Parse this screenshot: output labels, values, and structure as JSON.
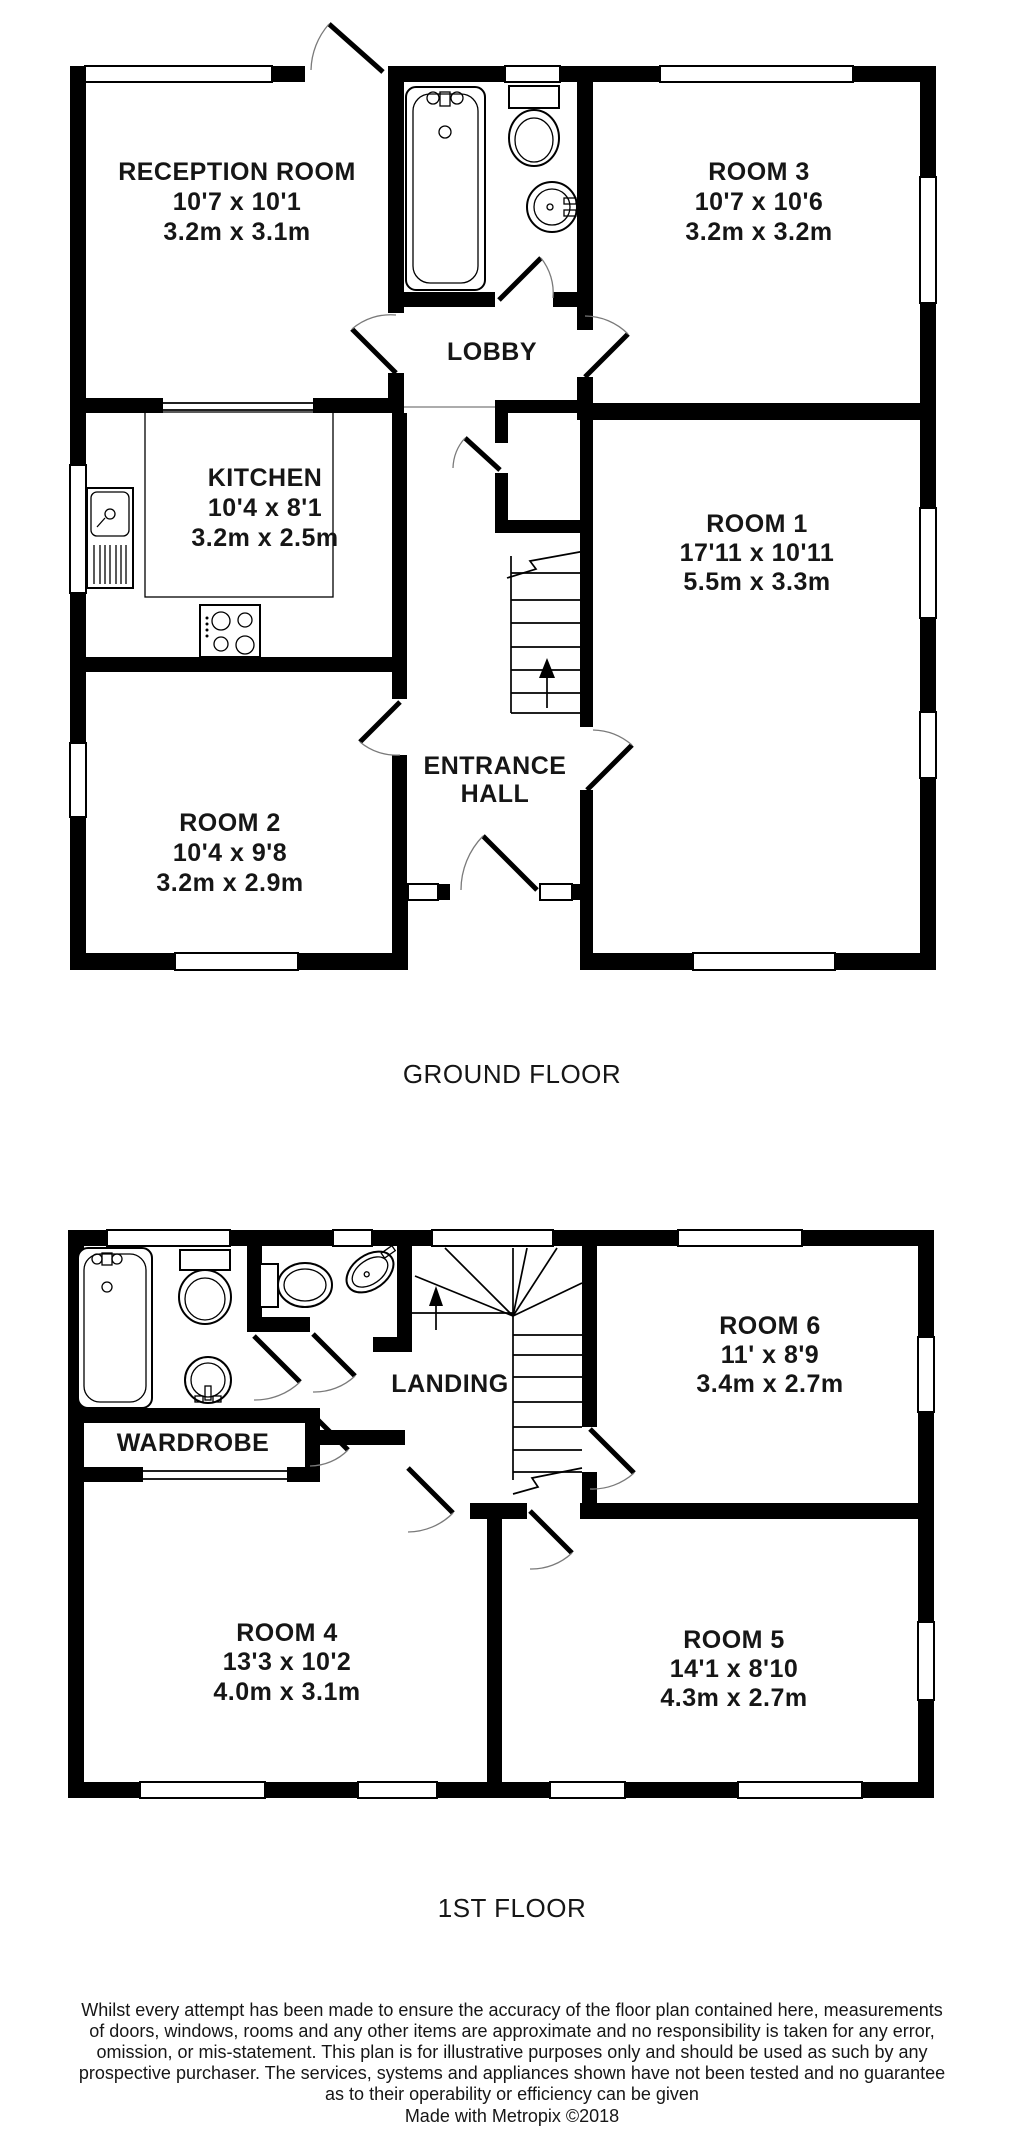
{
  "ground_floor": {
    "title": "GROUND FLOOR",
    "reception": {
      "name": "RECEPTION ROOM",
      "imperial": "10'7 x 10'1",
      "metric": "3.2m x 3.1m"
    },
    "room3": {
      "name": "ROOM 3",
      "imperial": "10'7 x 10'6",
      "metric": "3.2m x 3.2m"
    },
    "lobby": {
      "name": "LOBBY"
    },
    "kitchen": {
      "name": "KITCHEN",
      "imperial": "10'4 x 8'1",
      "metric": "3.2m x 2.5m"
    },
    "room1": {
      "name": "ROOM 1",
      "imperial": "17'11 x 10'11",
      "metric": "5.5m x 3.3m"
    },
    "entrance_hall": {
      "line1": "ENTRANCE",
      "line2": "HALL"
    },
    "room2": {
      "name": "ROOM 2",
      "imperial": "10'4 x 9'8",
      "metric": "3.2m x 2.9m"
    }
  },
  "first_floor": {
    "title": "1ST FLOOR",
    "room6": {
      "name": "ROOM 6",
      "imperial": "11' x 8'9",
      "metric": "3.4m x 2.7m"
    },
    "landing": {
      "name": "LANDING"
    },
    "wardrobe": {
      "name": "WARDROBE"
    },
    "room4": {
      "name": "ROOM 4",
      "imperial": "13'3 x 10'2",
      "metric": "4.0m x 3.1m"
    },
    "room5": {
      "name": "ROOM 5",
      "imperial": "14'1 x 8'10",
      "metric": "4.3m x 2.7m"
    }
  },
  "footer": {
    "disclaimer_lines": [
      "Whilst every attempt has been made to ensure the accuracy of the floor plan contained here, measurements",
      "of doors, windows, rooms and any other items are approximate and no responsibility is taken for any error,",
      "omission, or mis-statement. This plan is for illustrative purposes only and should be used as such by any",
      "prospective purchaser. The services, systems and appliances shown have not been tested and no guarantee",
      "as to their operability or efficiency can be given"
    ],
    "credit": "Made with Metropix ©2018"
  },
  "colors": {
    "wall": "#000000",
    "background": "#ffffff",
    "text": "#161616"
  }
}
